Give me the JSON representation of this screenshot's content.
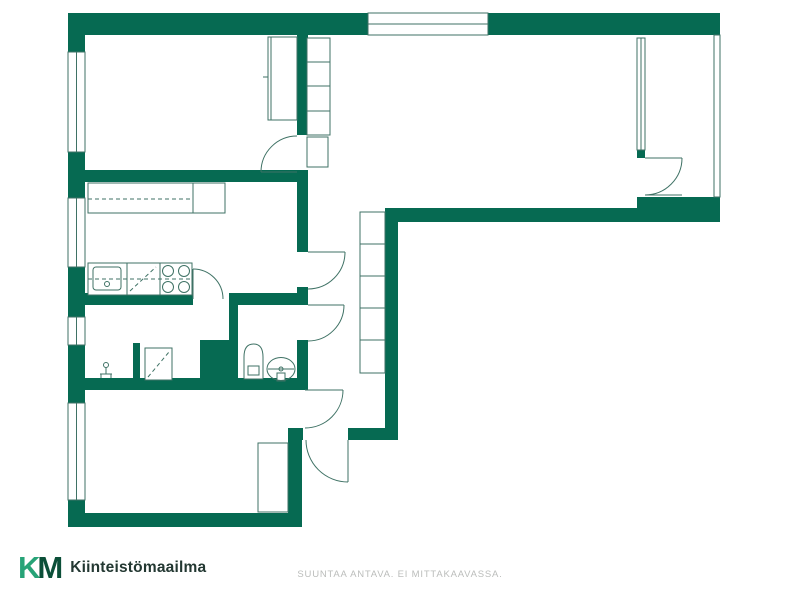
{
  "logo": {
    "k": "K",
    "m": "M",
    "wordmark": "Kiinteistömaailma"
  },
  "footer": {
    "disclaimer": "SUUNTAA ANTAVA. EI MITTAKAAVASSA."
  },
  "colors": {
    "wall": "#066a52",
    "line": "#3f7265",
    "logo_k": "#27a377",
    "logo_m": "#0b4f38",
    "wordmark": "#233832",
    "disclaimer": "#bbbdbb",
    "background": "#ffffff"
  },
  "plan": {
    "walls": [
      [
        68,
        13,
        300,
        22
      ],
      [
        488,
        13,
        232,
        22
      ],
      [
        68,
        35,
        17,
        17
      ],
      [
        68,
        152,
        17,
        46
      ],
      [
        68,
        267,
        17,
        50
      ],
      [
        68,
        345,
        17,
        58
      ],
      [
        68,
        500,
        17,
        27
      ],
      [
        68,
        513,
        234,
        14
      ],
      [
        288,
        428,
        14,
        99
      ],
      [
        288,
        428,
        15,
        12
      ],
      [
        348,
        428,
        50,
        12
      ],
      [
        385,
        208,
        13,
        232
      ],
      [
        385,
        208,
        252,
        14
      ],
      [
        637,
        197,
        83,
        25
      ],
      [
        68,
        170,
        240,
        12
      ],
      [
        68,
        293,
        125,
        12
      ],
      [
        229,
        293,
        79,
        12
      ],
      [
        68,
        378,
        240,
        12
      ],
      [
        297,
        13,
        11,
        122
      ],
      [
        297,
        172,
        11,
        80
      ],
      [
        297,
        287,
        11,
        18
      ],
      [
        297,
        340,
        11,
        43
      ],
      [
        229,
        305,
        9,
        73
      ],
      [
        200,
        340,
        38,
        43
      ],
      [
        133,
        343,
        7,
        40
      ],
      [
        637,
        150,
        8,
        8
      ]
    ],
    "windows": [
      [
        68,
        52,
        17,
        100,
        "v"
      ],
      [
        68,
        198,
        17,
        69,
        "v"
      ],
      [
        68,
        317,
        17,
        28,
        "v"
      ],
      [
        68,
        403,
        17,
        97,
        "v"
      ],
      [
        368,
        13,
        120,
        22,
        "h"
      ],
      [
        637,
        38,
        8,
        112,
        "v"
      ]
    ],
    "paths": [
      {
        "d": "M244,379 L244,357 Q244,344 253.5,344 Q263,344 263,357 L263,379 Z",
        "fill": "#fff"
      },
      {
        "d": "M197,208 L211,188 L206,200 L220,187",
        "fill": "none"
      }
    ],
    "boxes": [
      [
        268,
        37,
        29,
        83,
        0
      ],
      [
        307,
        38,
        23,
        97,
        0
      ],
      [
        307,
        137,
        21,
        30,
        0
      ],
      [
        360,
        212,
        25,
        161,
        0
      ],
      [
        258,
        443,
        30,
        69,
        0
      ],
      [
        88,
        183,
        105,
        30,
        0
      ],
      [
        193,
        183,
        32,
        30,
        0
      ],
      [
        88,
        263,
        39,
        32,
        0
      ],
      [
        93,
        267,
        28,
        23,
        3
      ],
      [
        127,
        263,
        33,
        32,
        0
      ],
      [
        160,
        263,
        32,
        32,
        0
      ],
      [
        145,
        348,
        27,
        32,
        0
      ],
      [
        714,
        35,
        6,
        162,
        0
      ],
      [
        248,
        366,
        11,
        9,
        0
      ],
      [
        277,
        373,
        8,
        8,
        0
      ]
    ],
    "lines": [
      [
        271,
        37,
        271,
        120
      ],
      [
        263,
        77,
        268,
        77
      ],
      [
        307,
        62,
        330,
        62
      ],
      [
        307,
        86,
        330,
        86
      ],
      [
        307,
        111,
        330,
        111
      ],
      [
        360,
        244,
        385,
        244
      ],
      [
        360,
        276,
        385,
        276
      ],
      [
        360,
        308,
        385,
        308
      ],
      [
        360,
        340,
        385,
        340
      ],
      [
        268,
        369,
        294,
        369
      ],
      [
        100,
        374,
        112,
        374
      ],
      [
        106,
        374,
        106,
        367
      ],
      [
        101,
        374,
        101,
        378
      ],
      [
        111,
        374,
        111,
        378
      ],
      [
        645,
        195,
        682,
        195
      ]
    ],
    "dashed": [
      [
        88,
        199,
        192,
        199
      ],
      [
        88,
        279,
        192,
        279
      ],
      [
        130,
        291,
        156,
        267
      ],
      [
        148,
        377,
        169,
        352
      ]
    ],
    "circles": [
      [
        168,
        271,
        5.5
      ],
      [
        184,
        271,
        5.5
      ],
      [
        168,
        287,
        5.5
      ],
      [
        184,
        287,
        5.5
      ],
      [
        107,
        284,
        2.5
      ],
      [
        106,
        365,
        2.5
      ],
      [
        281,
        369,
        2
      ]
    ],
    "ellipses": [
      [
        281,
        369,
        14,
        11.5
      ]
    ],
    "door_leaves": [
      [
        297,
        172,
        261,
        172
      ],
      [
        193,
        299,
        193,
        269
      ],
      [
        308,
        252,
        345,
        252
      ],
      [
        308,
        305,
        344,
        305
      ],
      [
        305,
        390,
        343,
        390
      ],
      [
        348,
        440,
        348,
        482
      ],
      [
        645,
        158,
        682,
        158
      ]
    ],
    "door_arcs": [
      [
        261,
        172,
        36,
        297,
        136
      ],
      [
        193,
        269,
        30,
        223,
        299
      ],
      [
        345,
        252,
        37,
        308,
        289
      ],
      [
        344,
        305,
        36,
        308,
        341
      ],
      [
        343,
        390,
        38,
        305,
        428
      ],
      [
        348,
        482,
        42,
        306,
        440
      ],
      [
        682,
        158,
        37,
        645,
        195
      ]
    ]
  }
}
